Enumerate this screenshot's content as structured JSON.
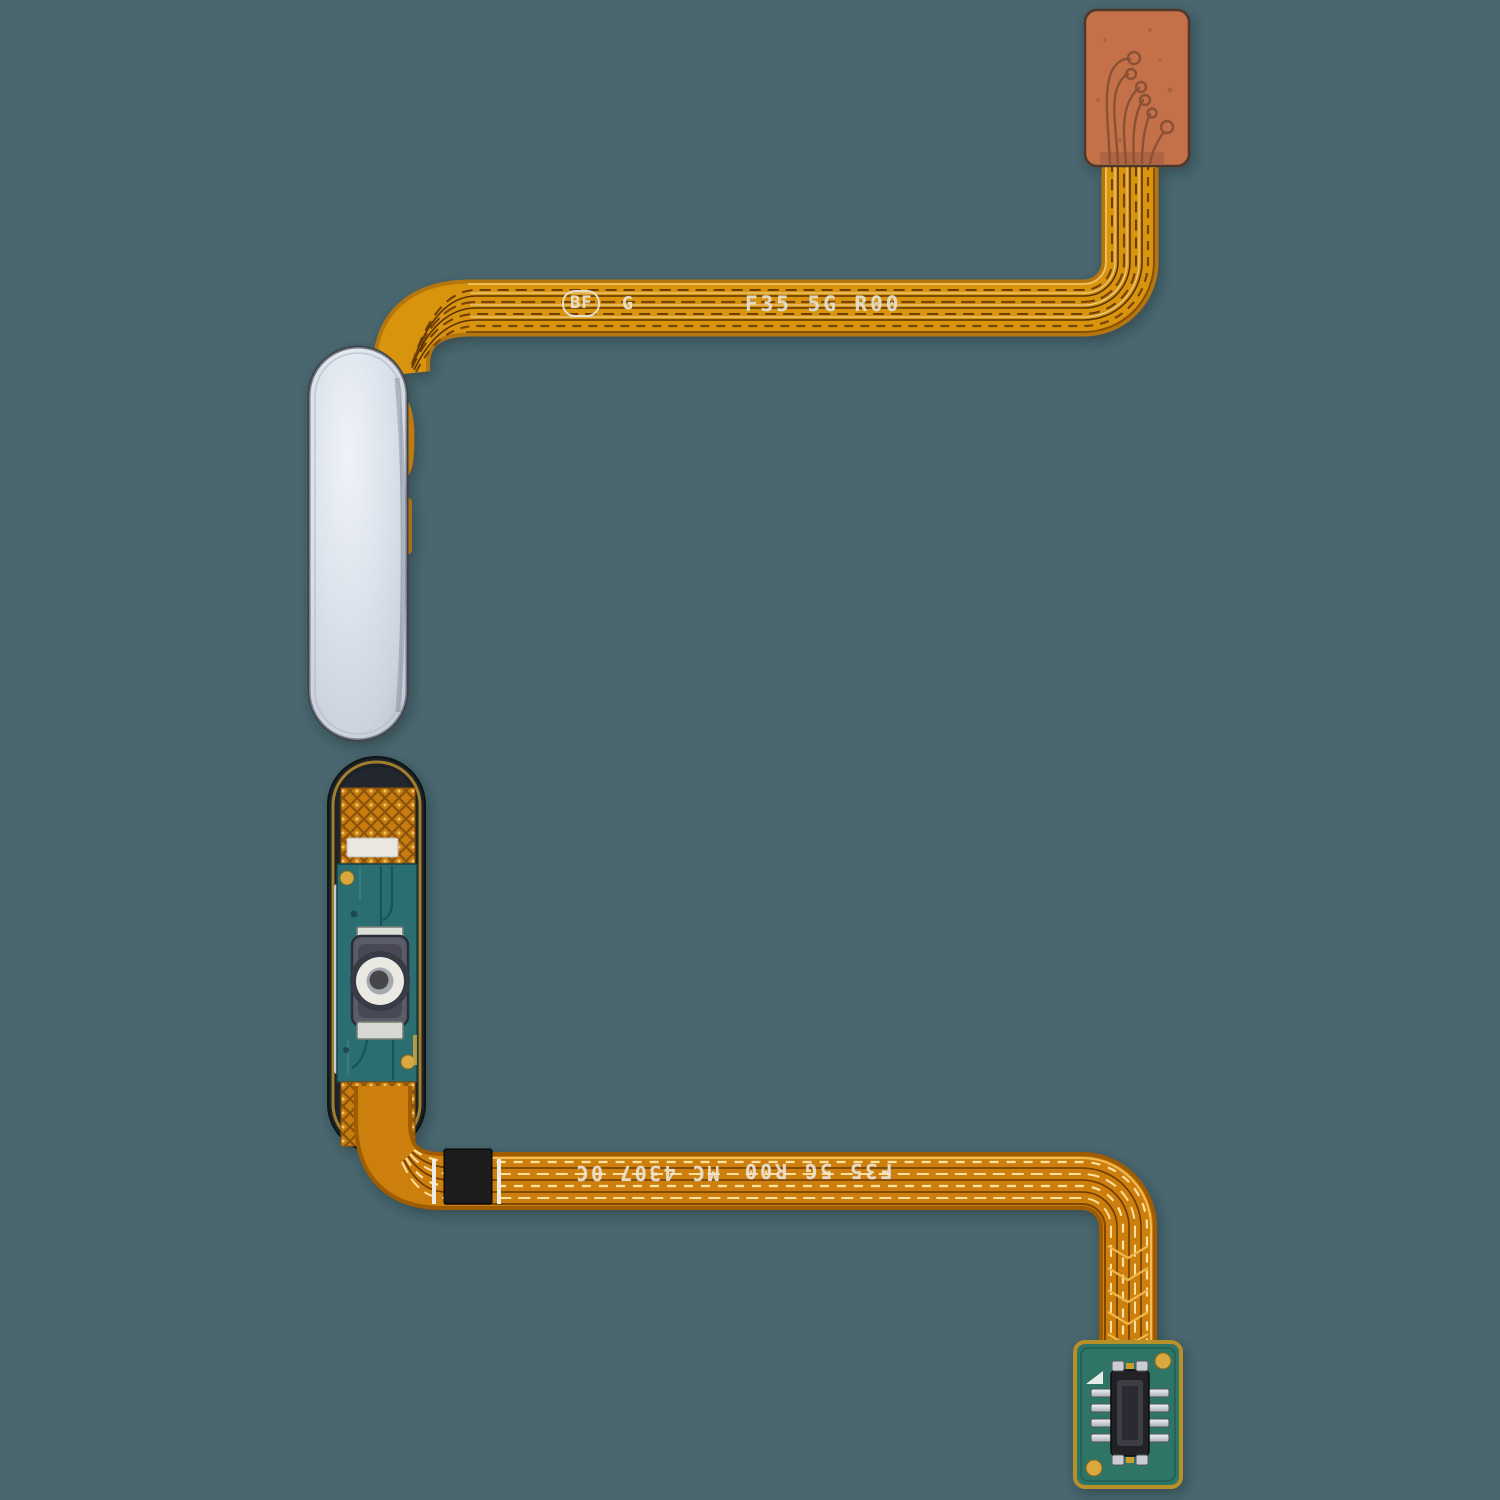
{
  "image": {
    "subject": "Fingerprint sensor home button flex cable replacement part, front and back views",
    "background_color": "#4a6770"
  },
  "top_assembly": {
    "view": "front (button side)",
    "cable_markings": {
      "badge": "BF",
      "grade": "G",
      "model": "F35 5G R00"
    }
  },
  "bottom_assembly": {
    "view": "back (PCB side)",
    "cable_markings": {
      "batch": "MC 4307 0C",
      "model": "F35 5G R00"
    }
  },
  "colors": {
    "background": "#4a6770",
    "flex_cable_amber": "#d9940f",
    "flex_cable_orange": "#cd7f0b",
    "contact_pad_terracotta": "#c4714a",
    "pcb_teal": "#2a6e72",
    "connector_pcb_teal": "#2d7568",
    "button_silver_blue": "#c7d0de",
    "gold_pad": "#d9a93f",
    "marking_text": "#e9e5d7"
  }
}
